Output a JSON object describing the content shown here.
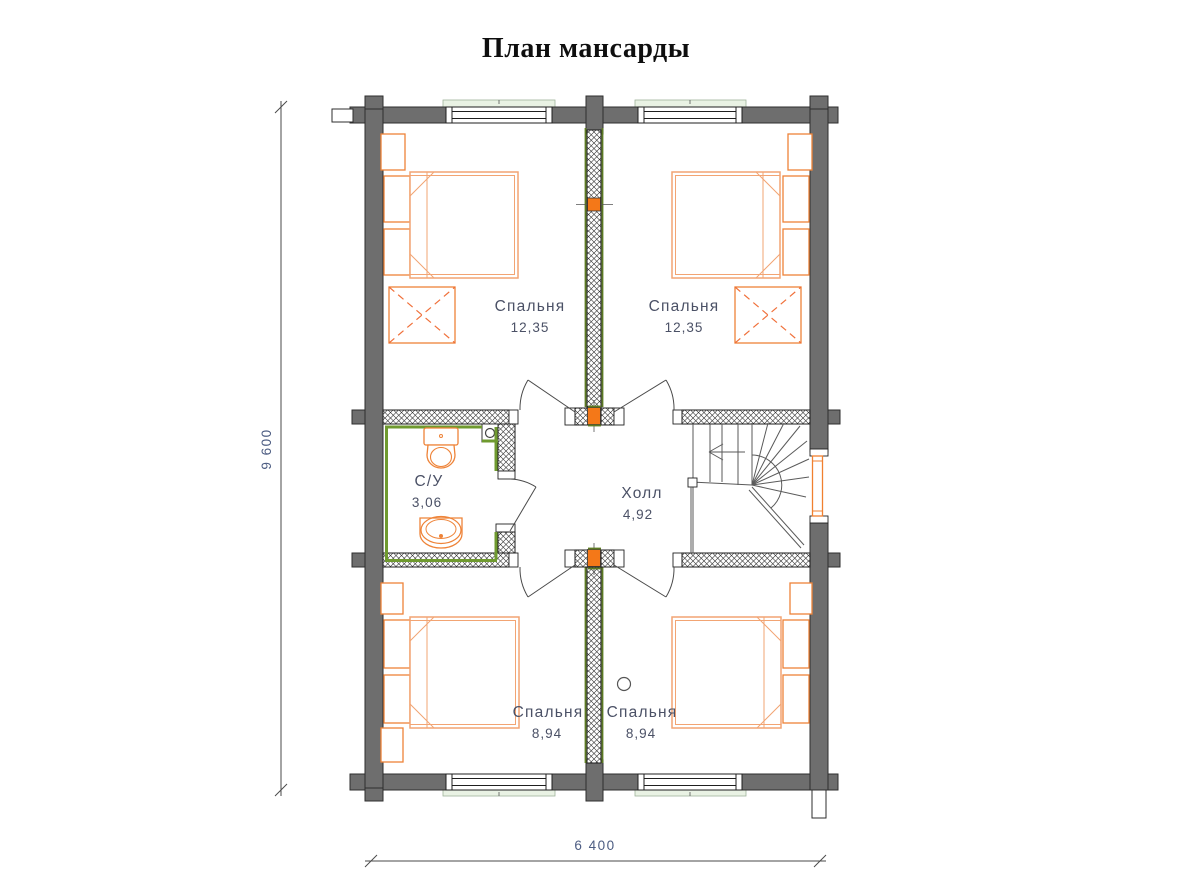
{
  "title": "План мансарды",
  "rooms": [
    {
      "id": "bedroom-top-left",
      "name": "Спальня",
      "area": "12,35"
    },
    {
      "id": "bedroom-top-right",
      "name": "Спальня",
      "area": "12,35"
    },
    {
      "id": "bathroom",
      "name": "С/У",
      "area": "3,06"
    },
    {
      "id": "hall",
      "name": "Холл",
      "area": "4,92"
    },
    {
      "id": "bedroom-bottom-left",
      "name": "Спальня",
      "area": "8,94"
    },
    {
      "id": "bedroom-bottom-right",
      "name": "Спальня",
      "area": "8,94"
    }
  ],
  "dimensions": {
    "overall_width": "6 400",
    "overall_height": "9 600"
  },
  "colors": {
    "wall_gray": "#6e6e6e",
    "furniture_orange": "#ee8338",
    "bed_orange": "#f2a473",
    "post_orange": "#f47818",
    "insulation_green": "#6f9a2f",
    "window_sill_green": "#e9f2e4",
    "label_text": "#4b5166",
    "dimension_text": "#4c5c82",
    "title_color": "#0f0f0f"
  }
}
